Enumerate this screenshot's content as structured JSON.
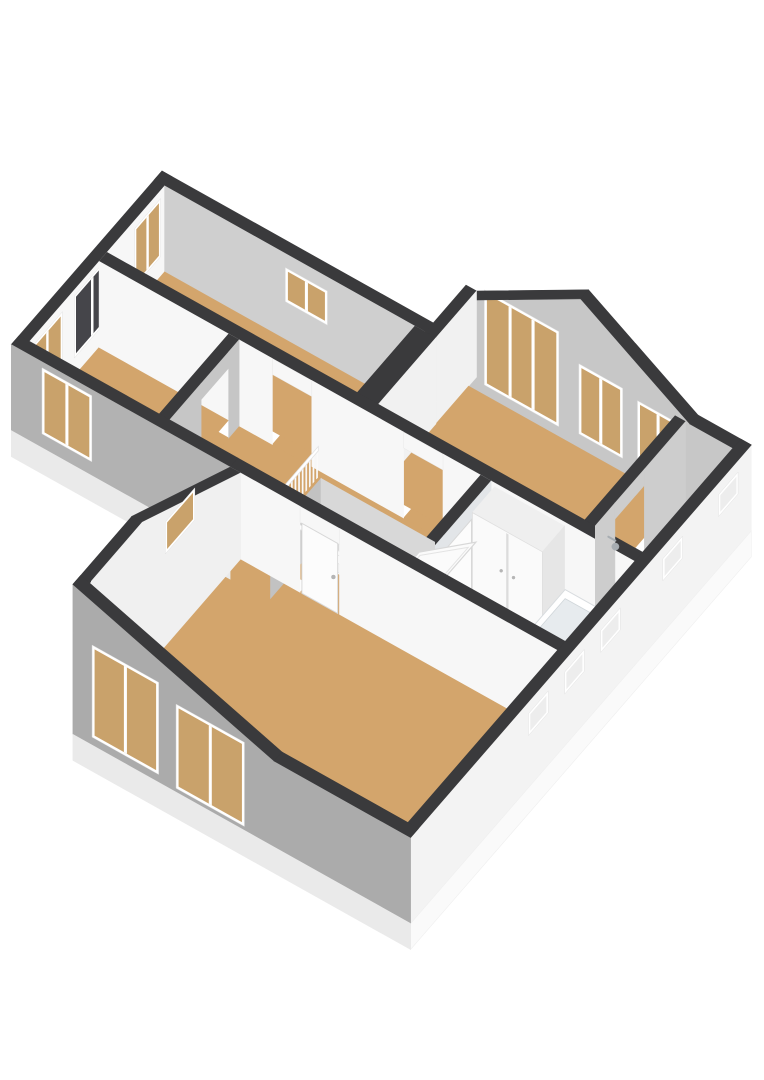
{
  "scene": {
    "type": "isometric-3d-floorplan",
    "background": "#ffffff",
    "canvas_width": 764,
    "canvas_height": 1080
  },
  "colors": {
    "wall_cap": "#3A3A3C",
    "floor_wood": "#D3A56C",
    "floor_bathroom": "#C9D3DC",
    "wall_white": "#F7F7F7",
    "wall_light": "#F1F1F1",
    "wall_gray": "#C7C7C7",
    "wall_midgray": "#CDCDCD",
    "wall_ne": "#CFCFCF",
    "wall_w2": "#C6C6C6",
    "wall_bath": "#E2E5E8",
    "wall_west": "#F0F0F0",
    "ext_gray": "#ABABAB",
    "ext_gray2": "#B2B2B2",
    "ext_white": "#F3F3F3",
    "skirt": "#EAEAEA",
    "skirt_white": "#FAFAFA",
    "window_frame": "#FFFFFF",
    "glass_tan": "#C9A26B",
    "glass_dark": "#45454A",
    "glass_slit": "#EDEDED",
    "rail_white": "#FAFAFA",
    "rail_top": "#FFFFFF",
    "tread": "#F3F3F3",
    "riser": "#E6E6E6",
    "hole_gray": "#C2C2C2",
    "hole_light": "#D8D8D8",
    "slab": "#FBFBFB",
    "slab_edge": "#D8D8D8",
    "door_leaf": "#FCFCFC",
    "door_edge": "#D8D8D8",
    "knob": "#B5B5B5",
    "tub": "#FFFFFF",
    "tub_inner": "#E7EBEE",
    "tub_side": "#F2F4F6",
    "tub_end": "#EAEEF1",
    "toilet": "#FBFBFB",
    "fixture": "#A7ADB2"
  },
  "inventory": {
    "wood_floor_rooms": 6,
    "bathroom_with_blue_floor": 1,
    "windows_total": 16,
    "exterior_slit_windows": 5,
    "door_openings": 6,
    "visible_door_leaves": 2,
    "staircase": {
      "flights": 1,
      "visible_treads": 8,
      "railings": 3,
      "open_stair_void": true,
      "sloped_stair_panel": 1
    },
    "bathtub": 1,
    "toilet_fixture": 1,
    "shower_head": 1,
    "closet_with_double_doors": 1
  }
}
